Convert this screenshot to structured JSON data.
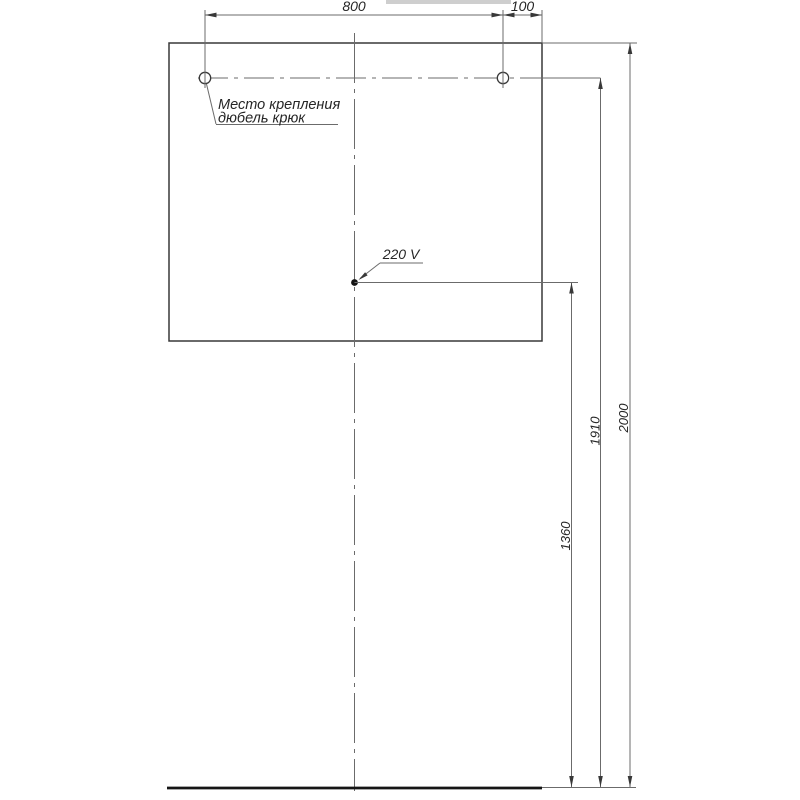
{
  "page": {
    "background": "#ffffff"
  },
  "drawing": {
    "type": "installation-diagram",
    "colors": {
      "thin_line": "#6b6b6b",
      "outline": "#383838",
      "thick_line": "#151515",
      "text": "#262626",
      "artifact": "#c5c5c5"
    },
    "dimensions": {
      "hole_spacing": "800",
      "hole_edge_offset": "100",
      "outlet_height": "1360",
      "hook_height": "1910",
      "overall_height": "2000"
    },
    "annotations": {
      "mount_note_line1": "Место крепления",
      "mount_note_line2": "дюбель крюк",
      "outlet_label": "220 V"
    }
  }
}
